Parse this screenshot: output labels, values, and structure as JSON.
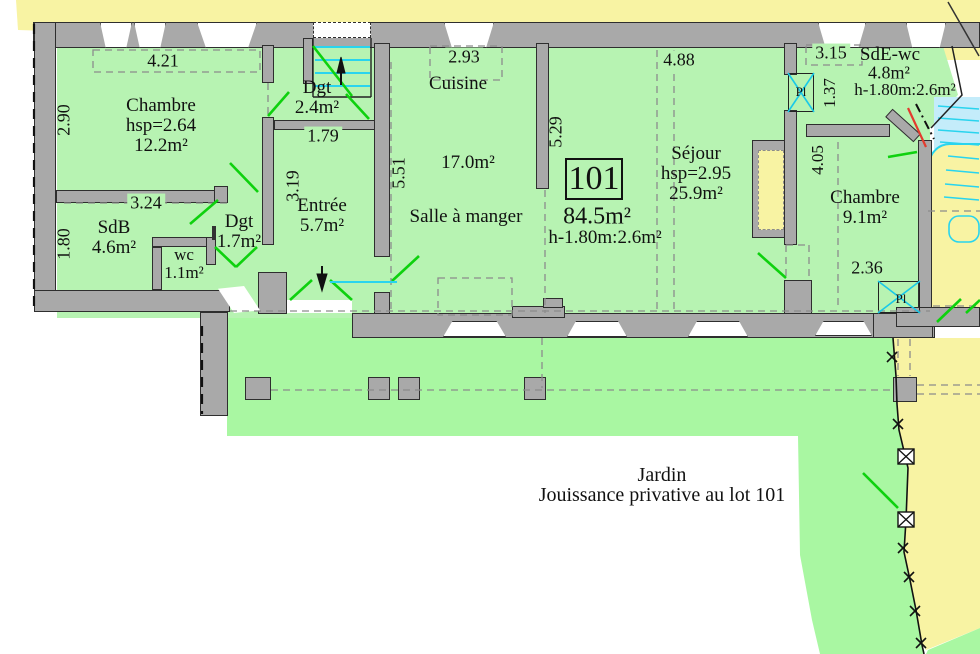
{
  "plan_type": "apartment-floor-plan",
  "lot": {
    "number": "101",
    "area": "84.5m²",
    "height_note": "h-1.80m:2.6m²"
  },
  "rooms": {
    "chambre1": {
      "name": "Chambre",
      "ceiling": "hsp=2.64",
      "area": "12.2m²"
    },
    "sdb": {
      "name": "SdB",
      "area": "4.6m²"
    },
    "wc": {
      "name": "wc",
      "area": "1.1m²"
    },
    "degagement1": {
      "name": "Dgt",
      "area": "1.7m²"
    },
    "degagement2": {
      "name": "Dgt",
      "area": "2.4m²"
    },
    "entree": {
      "name": "Entrée",
      "area": "5.7m²"
    },
    "cuisine": {
      "name": "Cuisine",
      "area": "17.0m²"
    },
    "salle_a_manger": {
      "name": "Salle à manger"
    },
    "sejour": {
      "name": "Séjour",
      "ceiling": "hsp=2.95",
      "area": "25.9m²"
    },
    "sde_wc": {
      "name": "SdE-wc",
      "area": "4.8m²",
      "height_note": "h-1.80m:2.6m²"
    },
    "chambre2": {
      "name": "Chambre",
      "area": "9.1m²"
    }
  },
  "closets": {
    "pl1": "Pl",
    "pl2": "Pl"
  },
  "dimensions": {
    "chambre1_width": "4.21",
    "chambre1_depth": "2.90",
    "sdb_width": "3.24",
    "sdb_depth": "1.80",
    "entree_width": "1.79",
    "entree_depth": "3.19",
    "cuisine_width": "2.93",
    "cuisine_depth": "5.51",
    "sejour_depth": "5.29",
    "sejour_width": "4.88",
    "sde_width": "3.15",
    "sde_depth": "1.37",
    "chambre2_depth": "4.05",
    "chambre2_width": "2.36"
  },
  "garden": {
    "title": "Jardin",
    "subtitle": "Jouissance privative au lot 101"
  },
  "colors": {
    "room_fill": "#b7f3b2",
    "garden_fill": "#a9f7a2",
    "neighbor_fill": "#f8f3a3",
    "wall_fill": "#a9a9a9",
    "stair_cyan": "#29d4ee",
    "door_swing_green": "#0ed10e",
    "boundary_red": "#e23b2e"
  }
}
